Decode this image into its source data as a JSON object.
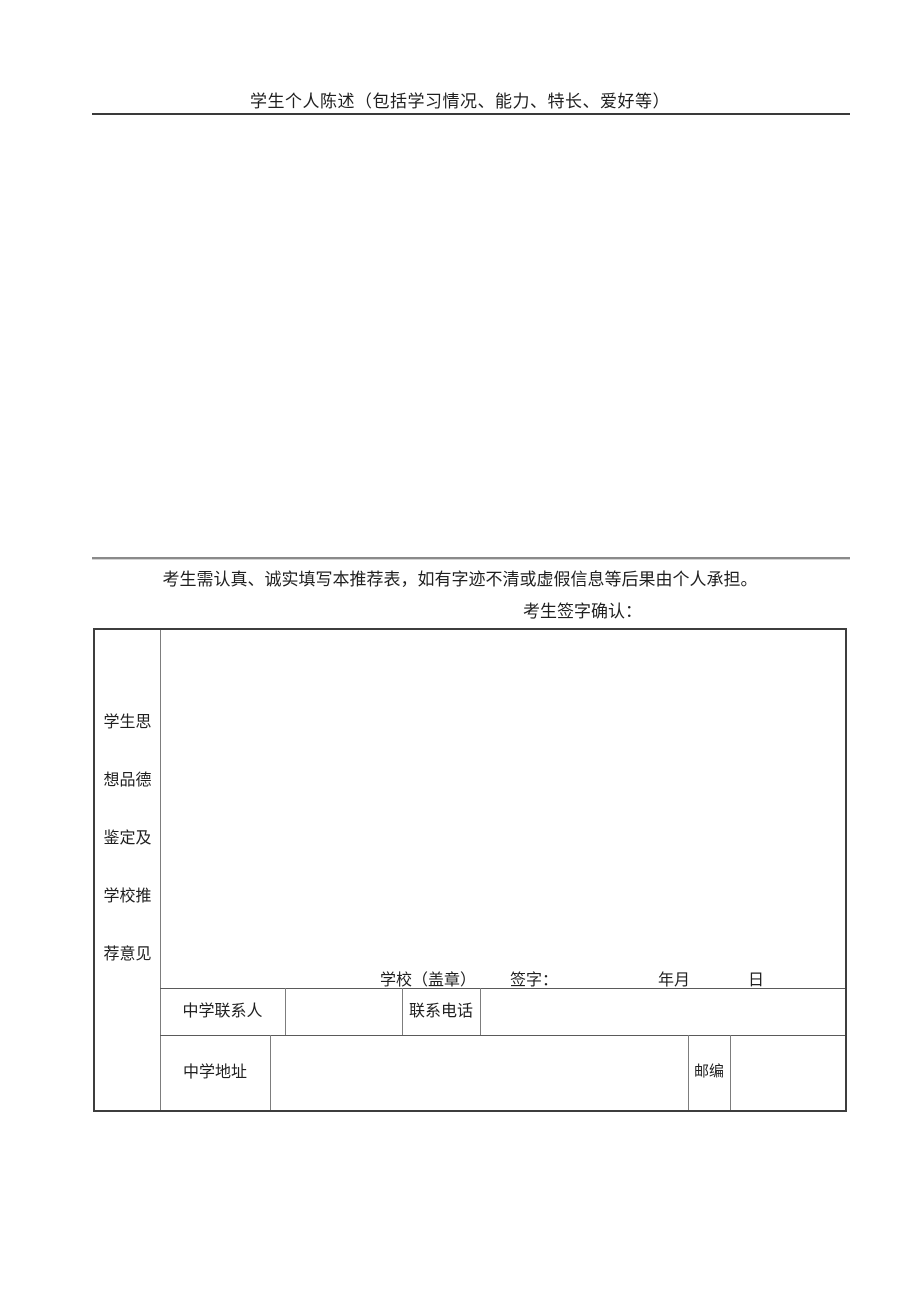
{
  "statement_section": {
    "title": "学生个人陈述（包括学习情况、能力、特长、爱好等）",
    "content": ""
  },
  "notice": {
    "text": "考生需认真、诚实填写本推荐表，如有字迹不清或虚假信息等后果由个人承担。",
    "sign_confirm_label": "考生签字确认："
  },
  "recommendation_table": {
    "side_label": "学生思\n想品德\n鉴定及\n学校推\n荐意见",
    "comment_content": "",
    "school_seal_label": "学校（盖章）",
    "sign_label": "签字：",
    "year_month_label": "年月",
    "day_label": "日",
    "contact_row": {
      "contact_label": "中学联系人",
      "contact_value": "",
      "phone_label": "联系电话",
      "phone_value": ""
    },
    "address_row": {
      "address_label": "中学地址",
      "address_value": "",
      "postcode_label": "邮编",
      "postcode_value": ""
    }
  },
  "colors": {
    "page_background": "#ffffff",
    "text": "#1f1f1f",
    "outer_border": "#3d3d3d",
    "inner_line": "#7d7d7d",
    "divider_gray": "#8a8a8a"
  }
}
